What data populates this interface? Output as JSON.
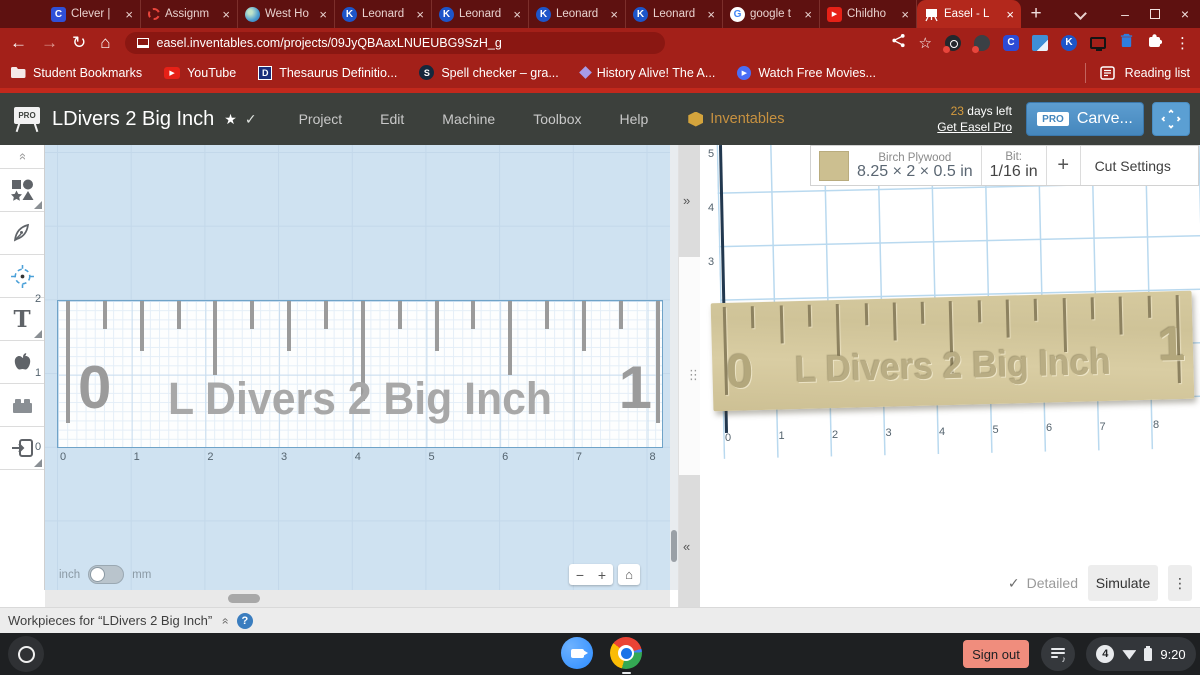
{
  "browser": {
    "tabs": [
      {
        "label": "Clever |",
        "close": "×"
      },
      {
        "label": "Assignm",
        "close": "×"
      },
      {
        "label": "West Ho",
        "close": "×"
      },
      {
        "label": "Leonard",
        "close": "×"
      },
      {
        "label": "Leonard",
        "close": "×"
      },
      {
        "label": "Leonard",
        "close": "×"
      },
      {
        "label": "Leonard",
        "close": "×"
      },
      {
        "label": "google t",
        "close": "×"
      },
      {
        "label": "Childho",
        "close": "×"
      },
      {
        "label": "Easel - L",
        "close": "×"
      }
    ],
    "new_tab": "+",
    "window_controls": {
      "minimize": "–",
      "close": "×"
    },
    "nav": {
      "back": "←",
      "forward": "→",
      "reload": "↻",
      "home": "⌂"
    },
    "url": "easel.inventables.com/projects/09JyQBAaxLNUEUBG9SzH_g",
    "bookmarks": {
      "student": "Student Bookmarks",
      "youtube": "YouTube",
      "thesaurus": "Thesaurus Definitio...",
      "spell": "Spell checker – gra...",
      "history": "History Alive! The A...",
      "movies": "Watch Free Movies...",
      "reading_list": "Reading list"
    }
  },
  "easel": {
    "logo_badge": "PRO",
    "title": "LDivers 2 Big Inch",
    "menus": {
      "project": "Project",
      "edit": "Edit",
      "machine": "Machine",
      "toolbox": "Toolbox",
      "help": "Help"
    },
    "brand": "Inventables",
    "trial": {
      "days": "23",
      "suffix": " days left",
      "link": "Get Easel Pro"
    },
    "carve": {
      "badge": "PRO",
      "label": "Carve..."
    },
    "material": {
      "name": "Birch Plywood",
      "dimensions": "8.25 × 2 × 0.5 in",
      "bit_label": "Bit:",
      "bit_value": "1/16 in",
      "add_bit": "+",
      "cut_settings": "Cut Settings"
    },
    "canvas": {
      "x_labels": [
        "0",
        "1",
        "2",
        "3",
        "4",
        "5",
        "6",
        "7",
        "8"
      ],
      "y_labels": [
        "2",
        "1",
        "0"
      ],
      "design_text": "L Divers 2 Big Inch",
      "ruler_start_number": "0",
      "ruler_end_number": "1",
      "tick_pattern": [
        "XL",
        "S",
        "M",
        "S",
        "L",
        "S",
        "M",
        "S",
        "C",
        "S",
        "M",
        "S",
        "L",
        "S",
        "M",
        "S",
        "XL"
      ],
      "unit_left": "inch",
      "unit_right": "mm",
      "zoom_out": "−",
      "zoom_in": "+",
      "zoom_home": "⌂"
    },
    "preview": {
      "x_labels": [
        "0",
        "1",
        "2",
        "3",
        "4",
        "5",
        "6",
        "7",
        "8"
      ],
      "y_labels": [
        "5",
        "4",
        "3"
      ],
      "design_text": "L Divers 2 Big Inch",
      "ruler_start_number": "0",
      "ruler_end_number": "1",
      "detailed_check": "✓",
      "detailed": "Detailed",
      "simulate": "Simulate",
      "menu": "⋮"
    },
    "panel": {
      "expand": "»",
      "collapse": "«",
      "drag": "⋮"
    },
    "workpieces": {
      "label": "Workpieces for “LDivers 2 Big Inch”",
      "collapse": "»",
      "help": "?"
    }
  },
  "icons": {
    "clever_letter": "C",
    "k_letter": "K",
    "google_letter": "G",
    "thesaurus_letter": "D",
    "spell_letter": "S",
    "play": "▶",
    "star_outline": "☆",
    "title_star": "★",
    "check": "✓",
    "menu_dots": "⋮",
    "chevron_double": "»"
  },
  "shelf": {
    "sign_out": "Sign out",
    "time": "9:20",
    "notification_count": "4"
  },
  "colors": {
    "accent_red": "#a32019",
    "active_tab_red": "#b3281c",
    "frame_red": "#5e1110",
    "header_dark": "#3c403c",
    "carve_blue": "#4f94c9",
    "canvas_blue": "#cfe2f1",
    "wood": "#d3c79d",
    "gold": "#c79140"
  }
}
